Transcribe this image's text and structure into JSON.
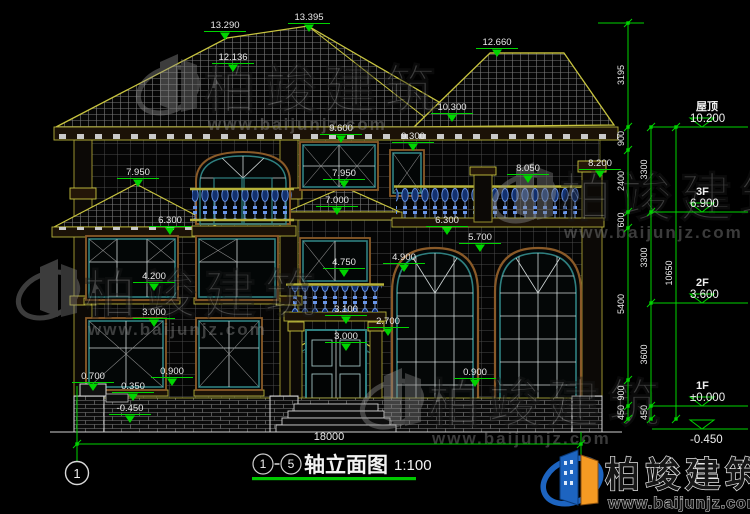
{
  "title": {
    "axis_start": "1",
    "axis_end": "5",
    "name": "轴立面图",
    "scale": "1:100"
  },
  "axis": {
    "label": "1"
  },
  "ground": {
    "total": "18000"
  },
  "levels": [
    {
      "name": "屋顶",
      "value": "10.200",
      "y": 127
    },
    {
      "name": "3F",
      "value": "6.900",
      "y": 212
    },
    {
      "name": "2F",
      "value": "3.600",
      "y": 303
    },
    {
      "name": "1F",
      "value": "±0.000",
      "y": 406
    },
    {
      "name": "",
      "value": "-0.450",
      "y": 429,
      "value_below": true
    }
  ],
  "chains": [
    {
      "x": 628,
      "ticks": [
        23,
        127,
        150,
        212,
        228,
        380,
        406,
        419
      ],
      "labels": [
        "3195",
        "900",
        "2400",
        "600",
        "5400",
        "900",
        "450"
      ]
    },
    {
      "x": 651,
      "ticks": [
        127,
        212,
        303,
        406,
        419
      ],
      "labels": [
        "3300",
        "3300",
        "3600",
        "450"
      ]
    },
    {
      "x": 676,
      "ticks": [
        127,
        419
      ],
      "labels": [
        "10650"
      ]
    }
  ],
  "marks": [
    {
      "value": "13.290",
      "x": 225,
      "y": 28
    },
    {
      "value": "13.395",
      "x": 309,
      "y": 20
    },
    {
      "value": "12.136",
      "x": 233,
      "y": 60
    },
    {
      "value": "12.660",
      "x": 497,
      "y": 45
    },
    {
      "value": "10.300",
      "x": 452,
      "y": 110
    },
    {
      "value": "9.600",
      "x": 341,
      "y": 131
    },
    {
      "value": "9.300",
      "x": 413,
      "y": 139
    },
    {
      "value": "8.200",
      "x": 600,
      "y": 166
    },
    {
      "value": "8.050",
      "x": 528,
      "y": 171
    },
    {
      "value": "7.950",
      "x": 138,
      "y": 175
    },
    {
      "value": "7.950",
      "x": 344,
      "y": 176
    },
    {
      "value": "7.000",
      "x": 337,
      "y": 203
    },
    {
      "value": "6.300",
      "x": 170,
      "y": 223
    },
    {
      "value": "6.300",
      "x": 447,
      "y": 223
    },
    {
      "value": "5.700",
      "x": 480,
      "y": 240
    },
    {
      "value": "4.750",
      "x": 344,
      "y": 265
    },
    {
      "value": "4.900",
      "x": 404,
      "y": 260
    },
    {
      "value": "4.200",
      "x": 154,
      "y": 279
    },
    {
      "value": "3.100",
      "x": 346,
      "y": 312
    },
    {
      "value": "2.700",
      "x": 388,
      "y": 324
    },
    {
      "value": "3.000",
      "x": 346,
      "y": 339
    },
    {
      "value": "3.000",
      "x": 154,
      "y": 315
    },
    {
      "value": "0.900",
      "x": 172,
      "y": 374
    },
    {
      "value": "0.900",
      "x": 475,
      "y": 375
    },
    {
      "value": "0.700",
      "x": 93,
      "y": 379
    },
    {
      "value": "0.350",
      "x": 133,
      "y": 389
    },
    {
      "value": "-0.450",
      "x": 130,
      "y": 411
    }
  ],
  "watermark": {
    "brand": "柏竣建筑",
    "site": "www.baijunjz.com",
    "positions": [
      {
        "x": 140,
        "y": 50
      },
      {
        "x": 496,
        "y": 158
      },
      {
        "x": 20,
        "y": 255
      },
      {
        "x": 364,
        "y": 364
      }
    ]
  },
  "logo": {
    "brand": "柏竣建筑",
    "site": "www.baijunjz.com"
  }
}
